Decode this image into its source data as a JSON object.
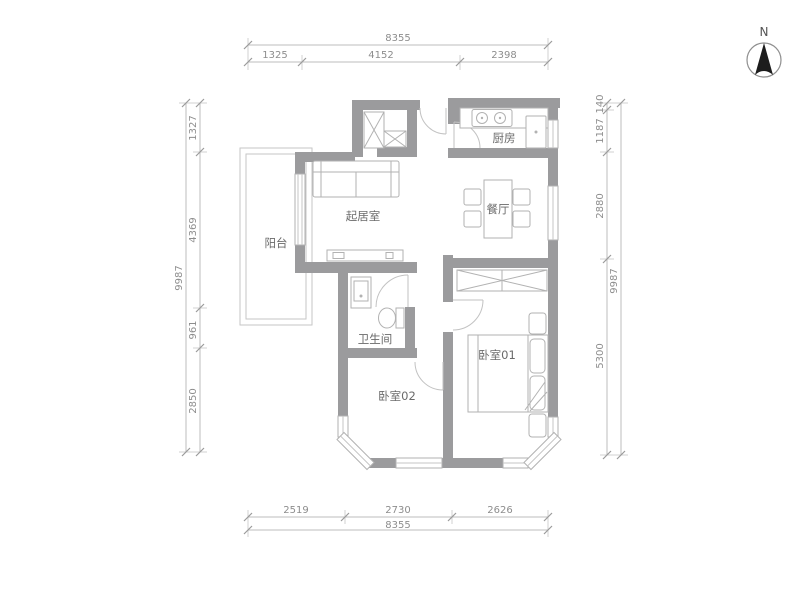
{
  "plan": {
    "title_hint": "apartment-floor-plan",
    "rooms": {
      "living_room": "起居室",
      "dining_room": "餐厅",
      "kitchen": "厨房",
      "balcony": "阳台",
      "bathroom": "卫生间",
      "bedroom_01": "卧室01",
      "bedroom_02": "卧室02"
    },
    "compass": {
      "north": "N"
    },
    "dimensions": {
      "top": {
        "total": "8355",
        "segments": [
          "1325",
          "4152",
          "2398"
        ]
      },
      "bottom": {
        "total": "8355",
        "segments": [
          "2519",
          "2730",
          "2626"
        ]
      },
      "left": {
        "total": "9987",
        "segments": [
          "1327",
          "4369",
          "961",
          "2850"
        ]
      },
      "right": {
        "total": "9987",
        "segments": [
          "140",
          "1187",
          "2880",
          "5300"
        ]
      }
    },
    "colors": {
      "wall": "#9b9b9d",
      "dimension_line": "#bcbcbc",
      "dimension_text": "#8d8d8d",
      "room_text": "#6a6a6a",
      "compass_arrow": "#1d1d1d"
    }
  }
}
